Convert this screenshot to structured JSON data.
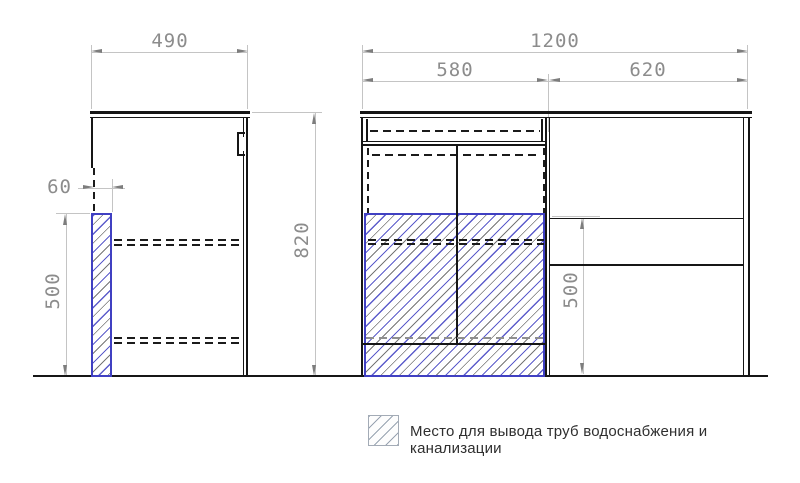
{
  "dimensions": {
    "side_width": "490",
    "side_pipe_offset": "60",
    "side_pipe_height": "500",
    "front_total_width": "1200",
    "front_left_width": "580",
    "front_right_width": "620",
    "front_height": "820",
    "front_shelf_height": "500"
  },
  "legend": {
    "text": "Место для вывода труб водоснабжения и канализации"
  },
  "colors": {
    "hatch_blue": "#4040c2",
    "drawing_line": "#161616",
    "dimension_line": "#c4c4c4",
    "dimension_text": "#8c8c8c",
    "legend_text": "#2f2f2f"
  }
}
